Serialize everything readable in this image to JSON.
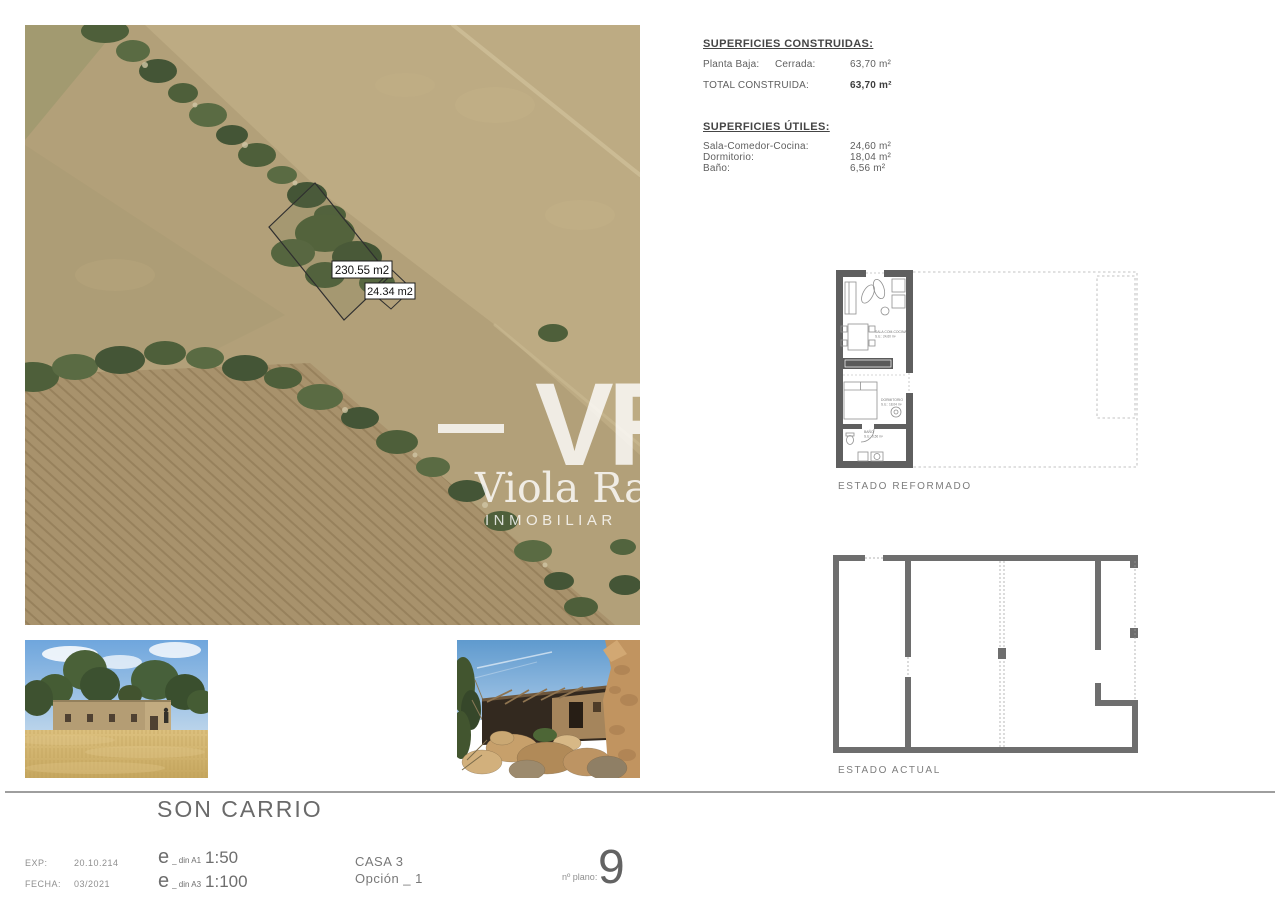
{
  "info": {
    "built": {
      "title": "SUPERFICIES CONSTRUIDAS:",
      "row_label": "Planta Baja:",
      "row_sub": "Cerrada:",
      "row_value": "63,70 m²",
      "total_label": "TOTAL CONSTRUIDA:",
      "total_value": "63,70 m²"
    },
    "useful": {
      "title": "SUPERFICIES ÚTILES:",
      "rows": [
        {
          "label": "Sala-Comedor-Cocina:",
          "value": "24,60 m²"
        },
        {
          "label": "Dormitorio:",
          "value": "18,04 m²"
        },
        {
          "label": "Baño:",
          "value": "6,56 m²"
        }
      ]
    }
  },
  "aerial": {
    "labels": {
      "main": "230.55 m2",
      "annex": "24.34 m2"
    },
    "watermark": {
      "initials": "VR",
      "name": "Viola Ra",
      "subtitle": "INMOBILIAR"
    }
  },
  "plans": {
    "reformado": {
      "caption": "ESTADO REFORMADO",
      "rooms": [
        {
          "name": "SALA COM-COCINA",
          "area": "S.U.: 24,60 m²"
        },
        {
          "name": "DORMITORIO",
          "area": "S.U.: 18,04 m²"
        },
        {
          "name": "BAÑO",
          "area": "S.U.: 6,56 m²"
        }
      ]
    },
    "actual": {
      "caption": "ESTADO ACTUAL"
    }
  },
  "footer": {
    "title": "SON CARRIO",
    "exp_label": "EXP:",
    "exp_value": "20.10.214",
    "fecha_label": "FECHA:",
    "fecha_value": "03/2021",
    "scales": [
      {
        "prefix": "e",
        "din": "_ din A1",
        "value": "1:50"
      },
      {
        "prefix": "e",
        "din": "_ din A3",
        "value": "1:100"
      }
    ],
    "casa": "CASA 3",
    "opcion": "Opción _ 1",
    "plano_label": "nº plano:",
    "plano_number": "9"
  },
  "colors": {
    "plan_wall": "#6e6e6e",
    "title_gray": "#6a6a6a",
    "watermark": "rgba(255,255,255,0.8)"
  }
}
